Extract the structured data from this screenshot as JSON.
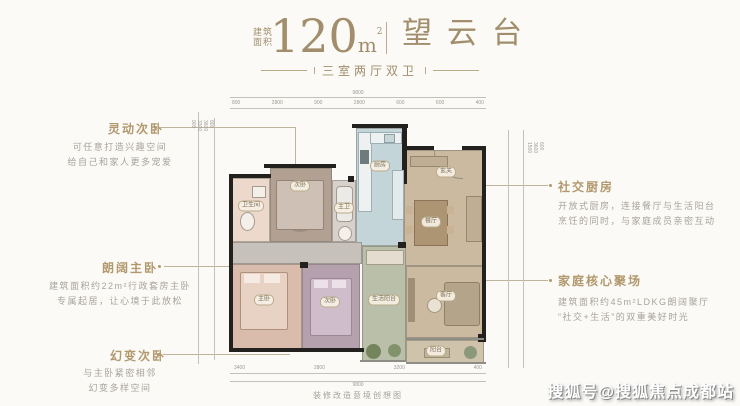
{
  "header": {
    "area_label_top": "建筑",
    "area_label_bottom": "面积",
    "area_value": "120",
    "area_unit": "m",
    "area_unit_sup": "2",
    "project_name": "望云台",
    "subtitle": "三室两厅双卫"
  },
  "annotations": {
    "left": [
      {
        "title": "灵动次卧",
        "desc1": "可任意打造兴趣空间",
        "desc2": "给自己和家人更多宠爱"
      },
      {
        "title": "朗阔主卧",
        "desc1": "建筑面积约22m²行政套房主卧",
        "desc2": "专属起居，让心境于此放松"
      },
      {
        "title": "幻变次卧",
        "desc1": "与主卧紧密相邻",
        "desc2": "幻变多样空间"
      }
    ],
    "right": [
      {
        "title": "社交厨房",
        "desc1": "开放式厨房，连接餐厅与生活阳台",
        "desc2": "烹饪的同时，与家庭成员亲密互动"
      },
      {
        "title": "家庭核心聚场",
        "desc1": "建筑面积约45m²LDKG朗阔聚厅",
        "desc2": "“社交+生活”的双重美好时光"
      }
    ]
  },
  "plan": {
    "rooms": [
      {
        "label": "卫生间"
      },
      {
        "label": "次卧"
      },
      {
        "label": "主卫"
      },
      {
        "label": "厨房"
      },
      {
        "label": "玄关"
      },
      {
        "label": "餐厅"
      },
      {
        "label": "客厅"
      },
      {
        "label": "主卧"
      },
      {
        "label": "次卧"
      },
      {
        "label": "生活阳台"
      },
      {
        "label": "阳台"
      }
    ],
    "dims": {
      "overall_top": "9800",
      "top": [
        "800",
        "2800",
        "900",
        "2800",
        "600",
        "600",
        "400"
      ],
      "bottom": [
        "3400",
        "2800",
        "3200",
        "400"
      ],
      "overall_bottom": "9800",
      "left": [
        "800",
        "3600",
        "3300",
        "900"
      ],
      "right": [
        "600",
        "3600",
        "1500"
      ]
    },
    "caption": "装修改造意境创想图"
  },
  "watermark": "搜狐号@搜狐焦点成都站",
  "colors": {
    "accent_gold": "#a28e6c",
    "annotation_title_gold": "#b2986d",
    "desc_gray": "#a8a49c",
    "kitchen_blue": "#c3d5d9",
    "dining_tan": "#cbbaa0",
    "master_rose": "#d9bcab",
    "bedroom_mauve": "#b5a0ad",
    "bedroom_taupe": "#b2a093",
    "bath_pink": "#ecd9cb",
    "bath_gray": "#d6d1cb",
    "balcony_green": "#b9bfa8",
    "wall_black": "#23211e"
  }
}
